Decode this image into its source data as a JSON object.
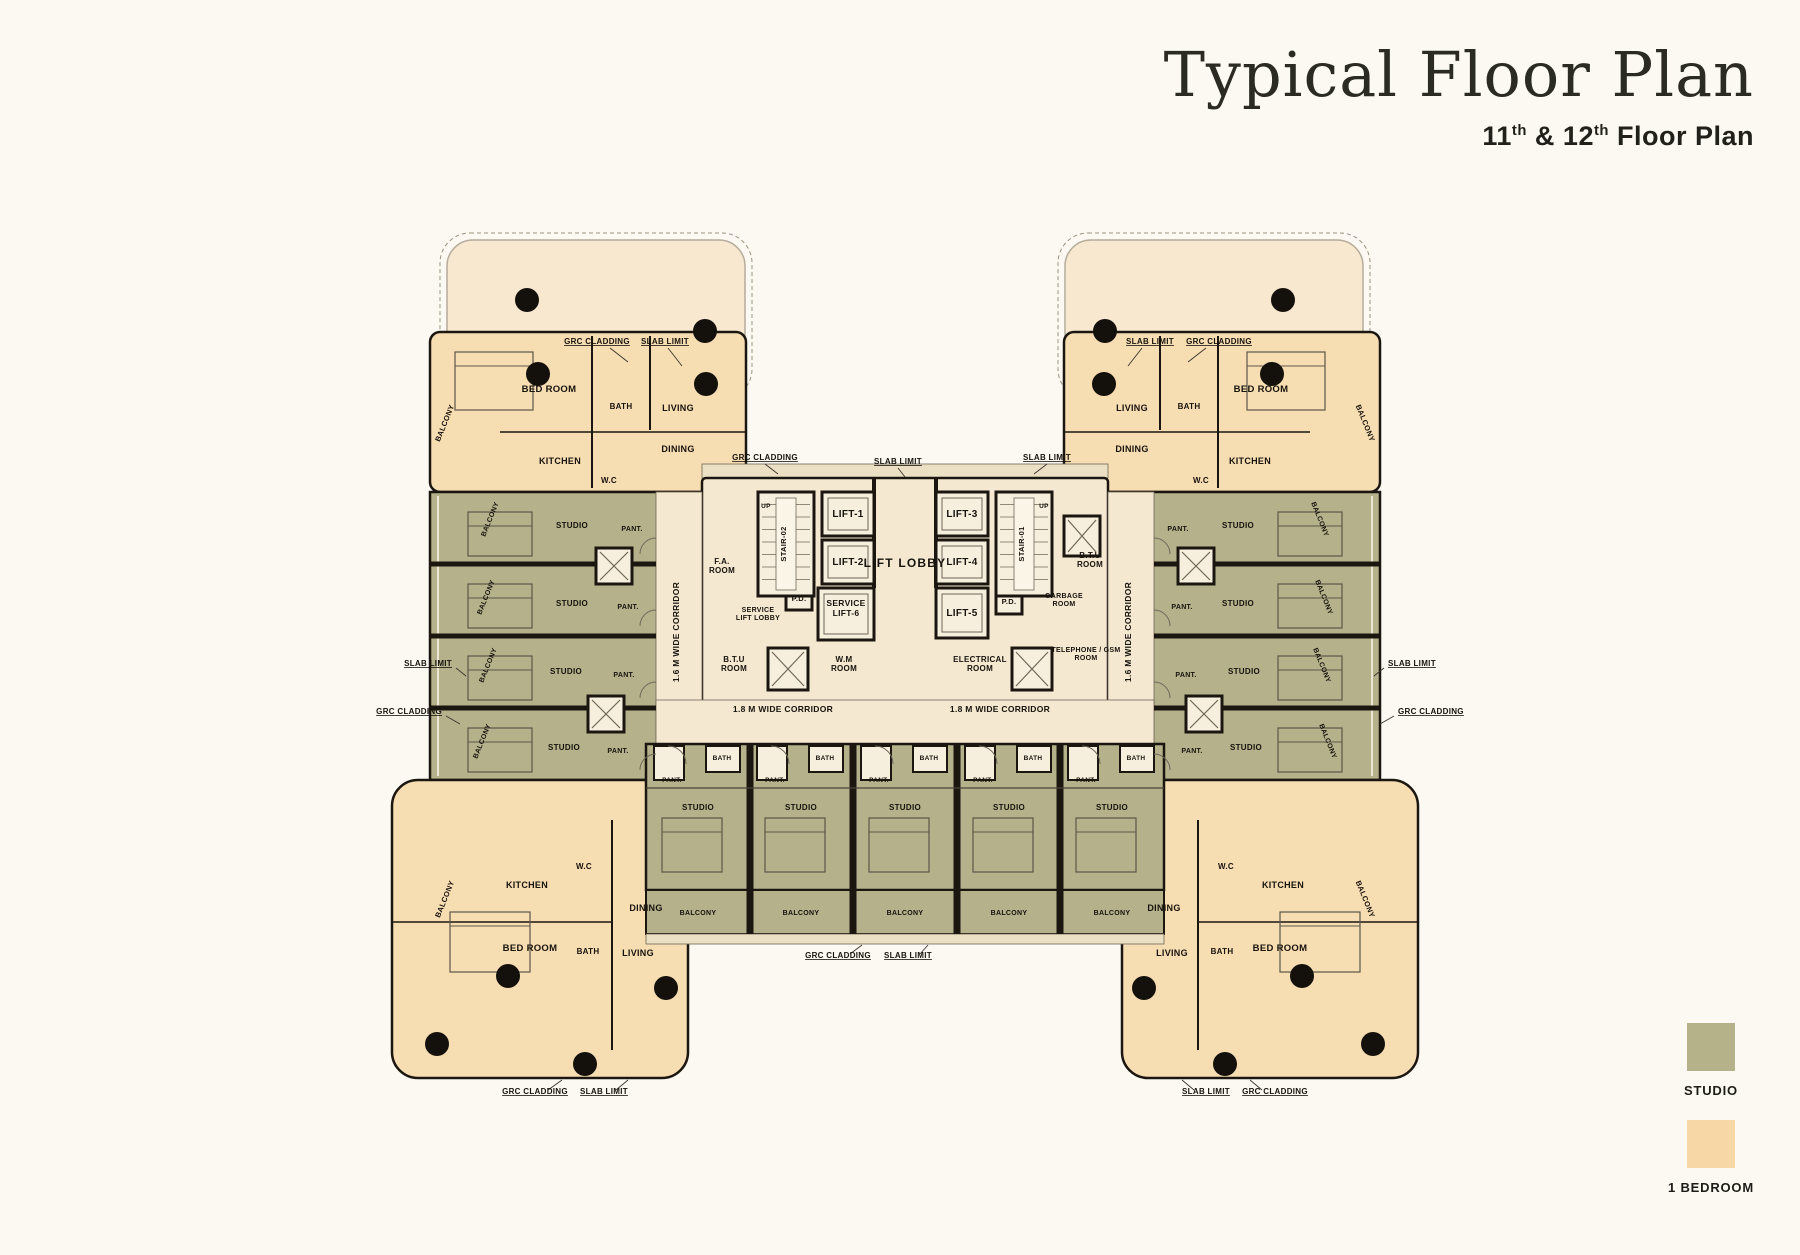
{
  "header": {
    "title": "Typical Floor Plan",
    "subtitle_parts": [
      {
        "text": "11"
      },
      {
        "text": "th",
        "sup": true
      },
      {
        "text": " & 12"
      },
      {
        "text": "th",
        "sup": true
      },
      {
        "text": " Floor Plan"
      }
    ]
  },
  "legend": {
    "items": [
      {
        "label": "STUDIO",
        "color": "#b5b289"
      },
      {
        "label": "1 BEDROOM",
        "color": "#f7d7a5"
      }
    ]
  },
  "colors": {
    "bg": "#fbf9f2",
    "studio": "#b4b18b",
    "one_bedroom": "#f7ddb2",
    "pale": "#f8e8d0",
    "cream": "#f4e8d0",
    "band": "#ece0c4",
    "box": "#f7efde",
    "wall": "#1b1610",
    "line": "#6e6758",
    "rail": "#ece5d4",
    "ink": "#17130d",
    "title": "#2b2a23"
  },
  "plan": {
    "core": {
      "lift_lobby": "LIFT LOBBY",
      "lifts": [
        "LIFT-1",
        "LIFT-2",
        "LIFT-3",
        "LIFT-4",
        "LIFT-5"
      ],
      "service_lift": "SERVICE\nLIFT-6",
      "service_lift_lobby": "SERVICE\nLIFT LOBBY",
      "stair_01": "STAIR-01",
      "stair_02": "STAIR-02",
      "fa_room": "F.A.\nROOM",
      "pd": "P.D.",
      "btu_room": "B.T.U\nROOM",
      "wm_room": "W.M\nROOM",
      "electrical_room": "ELECTRICAL\nROOM",
      "garbage_room": "GARBAGE\nROOM",
      "telephone_room": "TELEPHONE / GSM\nROOM",
      "up": "UP"
    },
    "corridor_wing": "1.6 M WIDE CORRIDOR",
    "corridor_lobby": "1.8 M WIDE CORRIDOR",
    "rooms": {
      "studio": "STUDIO",
      "bedroom": "BED ROOM",
      "living": "LIVING",
      "dining": "DINING",
      "kitchen": "KITCHEN",
      "bath": "BATH",
      "wc": "W.C",
      "pantry": "PANT.",
      "balcony": "BALCONY"
    },
    "notes": {
      "grc": "GRC CLADDING",
      "slab": "SLAB LIMIT"
    }
  }
}
